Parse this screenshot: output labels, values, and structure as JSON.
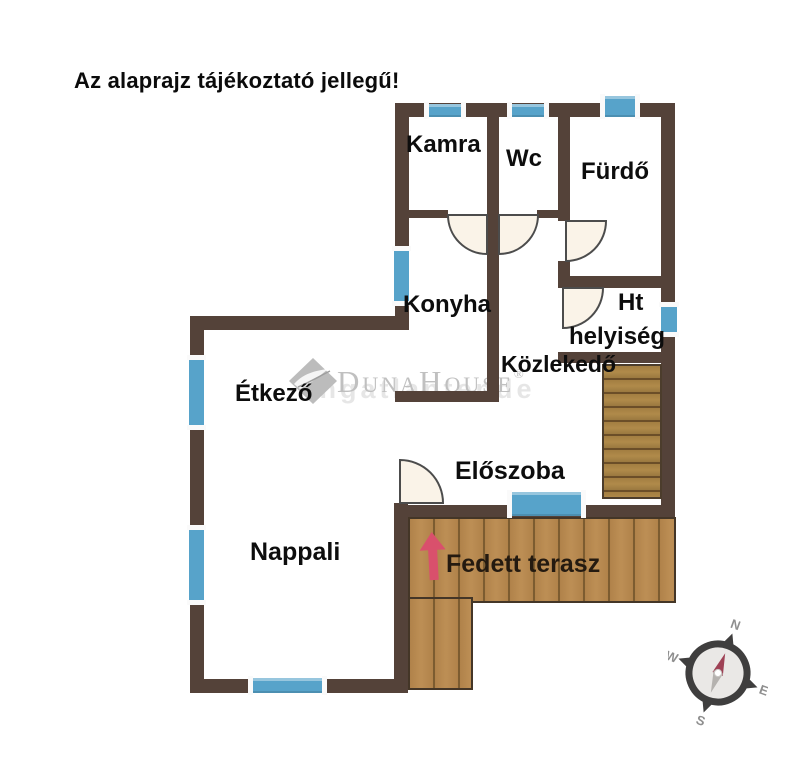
{
  "title": "Az alaprajz tájékoztató jellegű!",
  "rooms": {
    "kamra": "Kamra",
    "wc": "Wc",
    "furdo": "Fürdő",
    "konyha": "Konyha",
    "ht_line1": "Ht",
    "ht_line2": "helyiség",
    "kozlekedo": "Közlekedő",
    "etkezo": "Étkező",
    "eloszoba": "Előszoba",
    "nappali": "Nappali",
    "fedett_terasz": "Fedett terasz"
  },
  "watermark": {
    "brand": "DunaHouse",
    "registered": "®",
    "faint_text": "ingatlantende"
  },
  "compass": {
    "north": "N",
    "east": "E",
    "south": "S",
    "west": "W"
  },
  "colors": {
    "wall": "#544239",
    "window": "#57a3ca",
    "wood": "#b0824a",
    "arrow": "#d9506c"
  }
}
